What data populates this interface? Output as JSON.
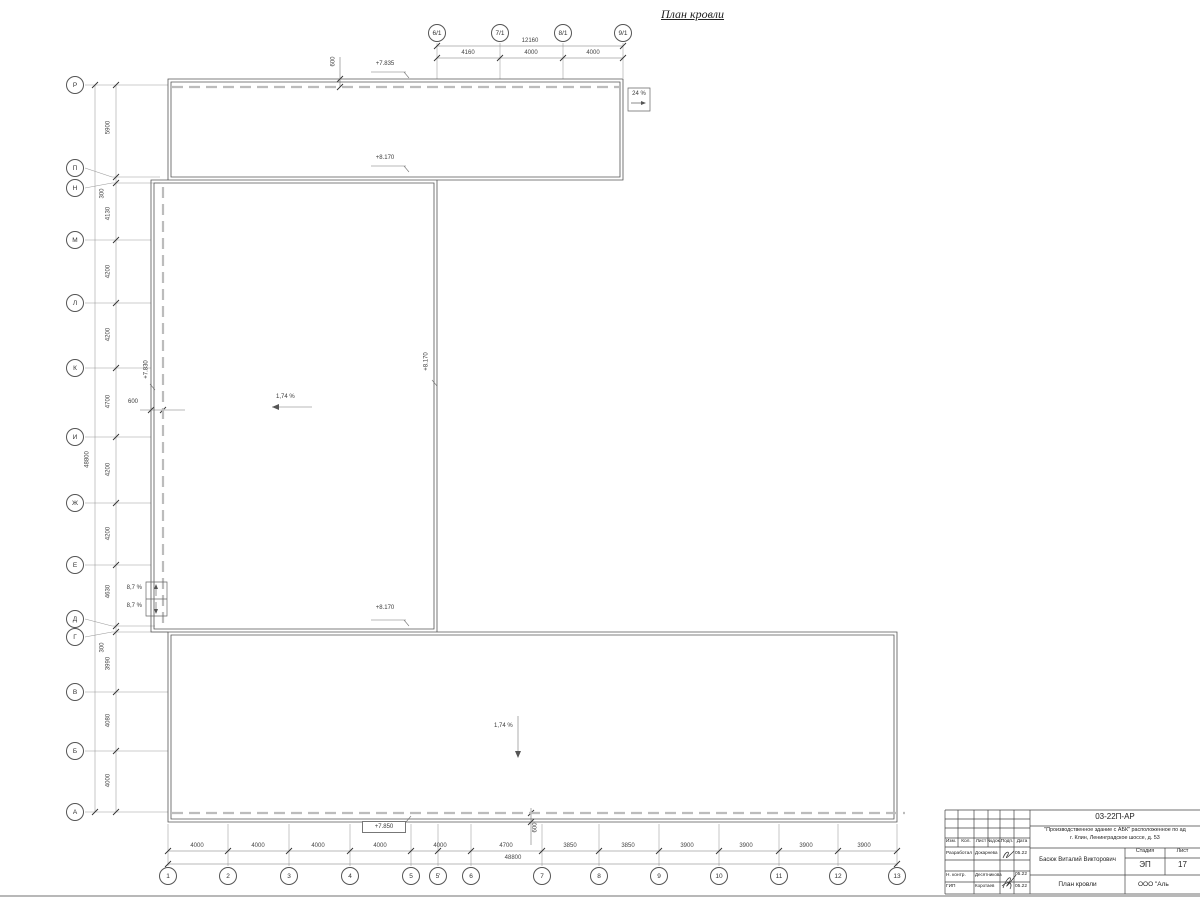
{
  "sheet": {
    "title": "План кровли"
  },
  "axes": {
    "top": {
      "bubbles": [
        "6/1",
        "7/1",
        "8/1",
        "9/1"
      ],
      "total": "12160",
      "segments": [
        "4160",
        "4000",
        "4000"
      ]
    },
    "left": {
      "bubbles": [
        "Р",
        "П",
        "Н",
        "М",
        "Л",
        "К",
        "И",
        "Ж",
        "Е",
        "Д",
        "Г",
        "В",
        "Б",
        "А"
      ],
      "segments": [
        "5900",
        "4130",
        "4200",
        "4200",
        "4700",
        "4200",
        "4200",
        "4630",
        "3990",
        "4080",
        "4000"
      ],
      "small": [
        "300",
        "300"
      ],
      "total": "48800"
    },
    "bottom": {
      "bubbles": [
        "1",
        "2",
        "3",
        "4",
        "5",
        "5'",
        "6",
        "7",
        "8",
        "9",
        "10",
        "11",
        "12",
        "13"
      ],
      "segments": [
        "4000",
        "4000",
        "4000",
        "4000",
        "4000",
        "4700",
        "3850",
        "3850",
        "3900",
        "3900",
        "3900",
        "3900"
      ],
      "total": "48800"
    }
  },
  "annotations": {
    "elev_top": "+7.835",
    "elev_ridge": "+8.170",
    "elev_left": "+7.830",
    "elev_bottom": "+7.850",
    "slope_roof": "1,74 %",
    "slope_ramp": "24 %",
    "slope_side": "8,7 %",
    "eave_offset": "600"
  },
  "titleblock": {
    "doc_number": "03-22П-АР",
    "project_line1": "\"Производственное здание с АБК\" расположенное по ад",
    "project_line2": "г. Клин, Ленинградское шоссе, д. 53",
    "cols": [
      "Изм.",
      "Кол.",
      "Лист",
      "№док.",
      "Подп.",
      "Дата"
    ],
    "row_roles": [
      "Разработал",
      "Н. контр.",
      "ГИП"
    ],
    "row_names": [
      "Докарнева",
      "Десятникова",
      "Коротаев"
    ],
    "date": "05.22",
    "designer_name": "Басюк Виталий Викторович",
    "stage_label": "Стадия",
    "sheet_label": "Лист",
    "stage": "ЭП",
    "sheet_no": "17",
    "drawing_name": "План кровли",
    "company": "ООО \"Аль"
  }
}
